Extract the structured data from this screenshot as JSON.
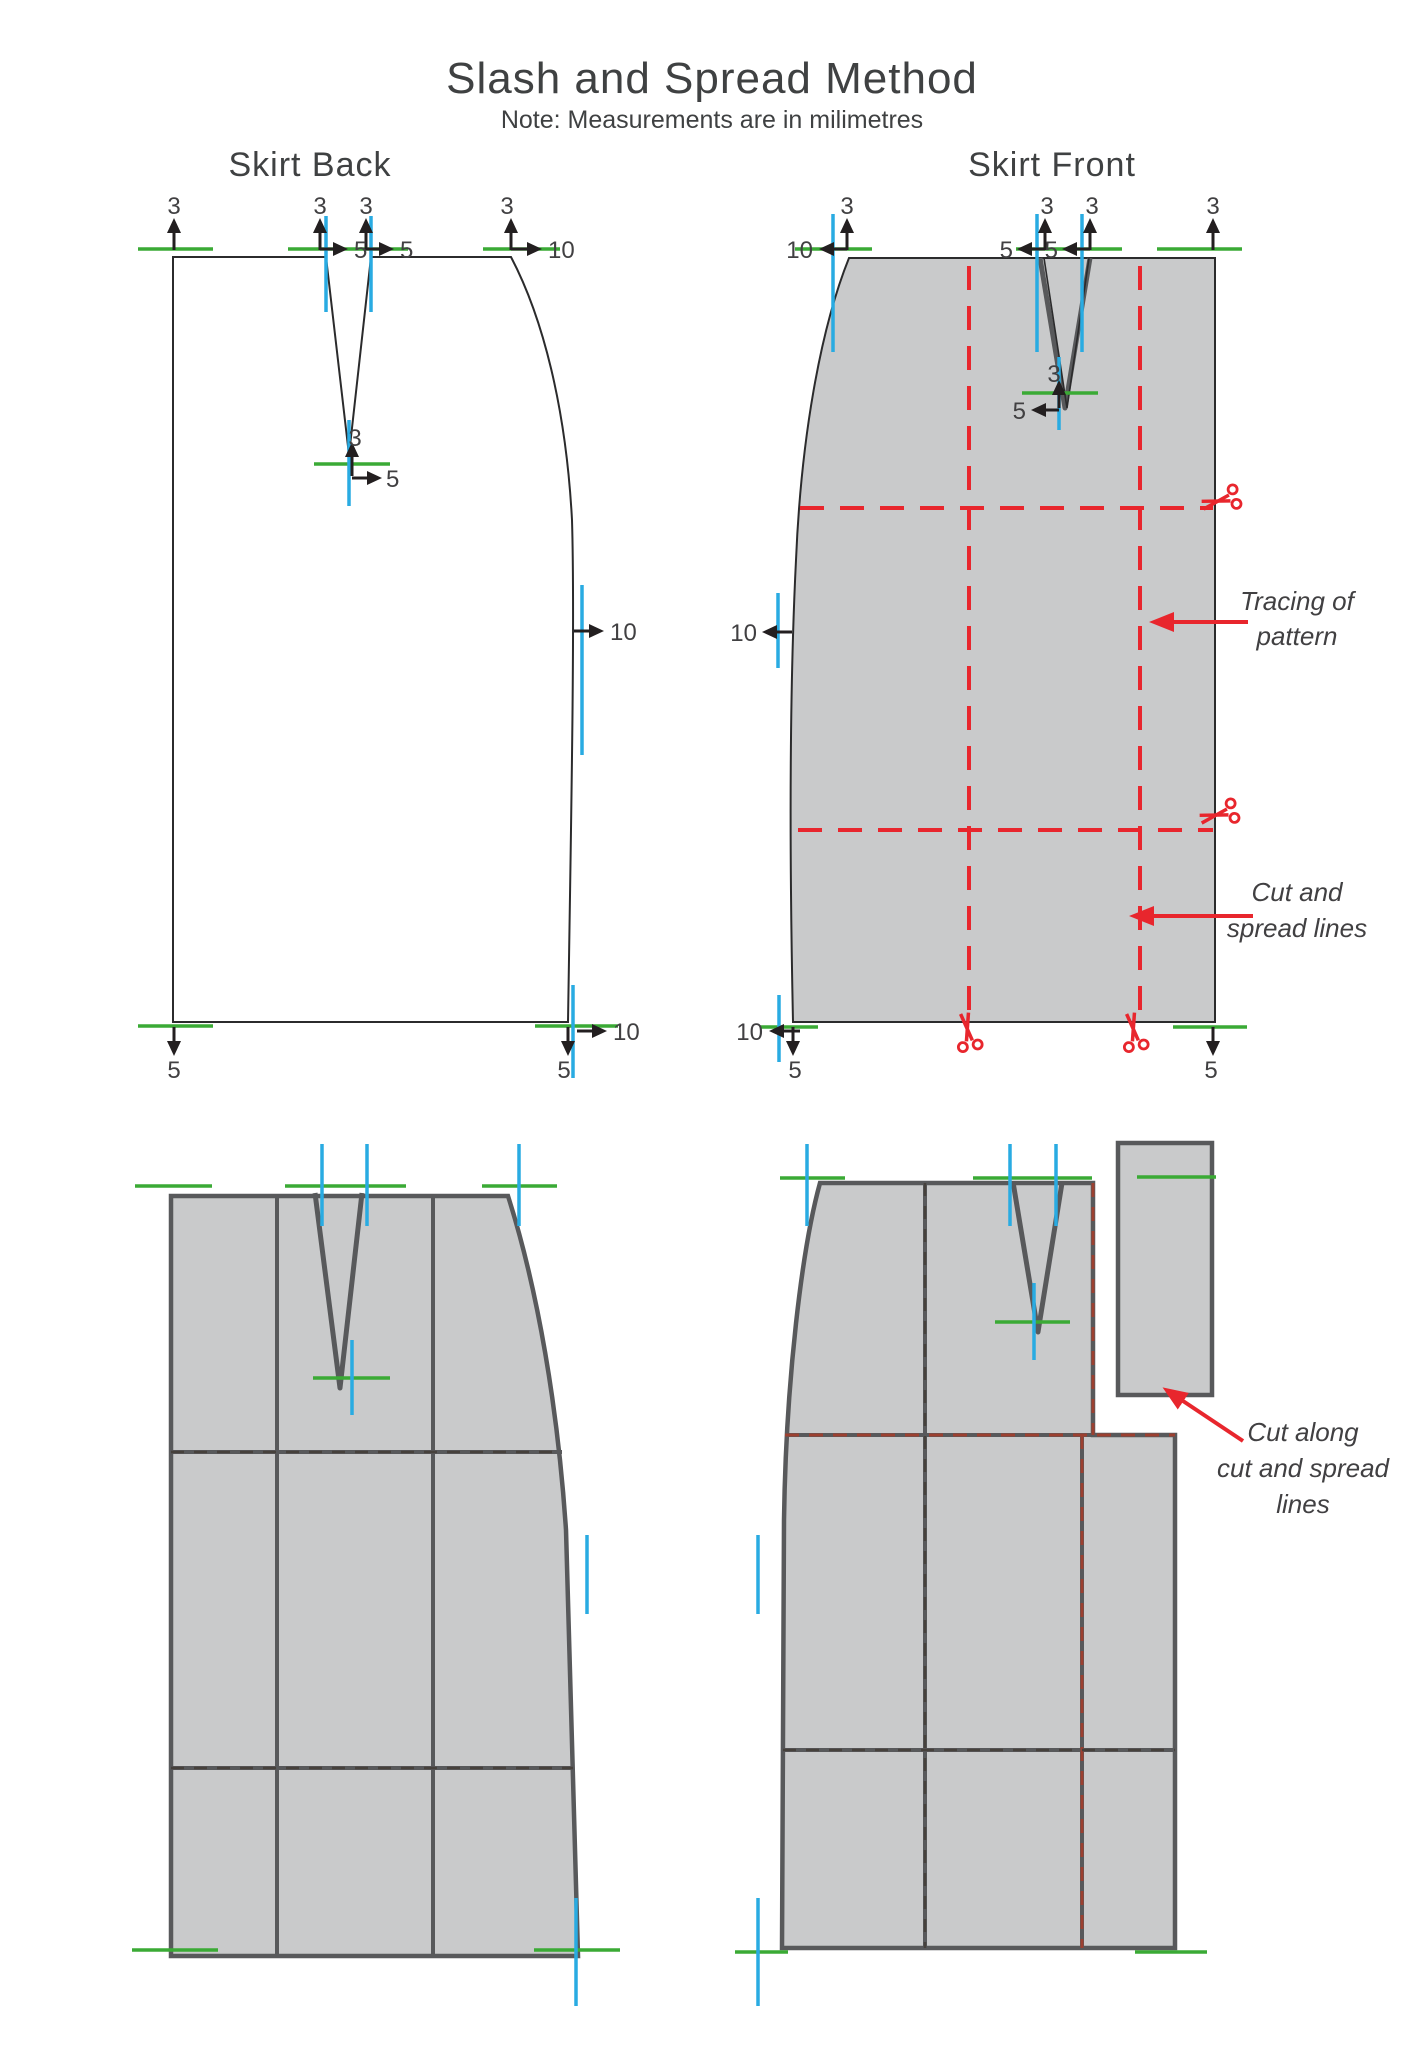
{
  "header": {
    "title": "Slash and Spread Method",
    "subtitle": "Note: Measurements are in milimetres"
  },
  "sections": {
    "back_label": "Skirt Back",
    "front_label": "Skirt Front"
  },
  "values": {
    "v3": "3",
    "v5": "5",
    "v10": "10"
  },
  "annotations": {
    "tracing_line1": "Tracing of",
    "tracing_line2": "pattern",
    "cut_spread_line1": "Cut and",
    "cut_spread_line2": "spread lines",
    "cut_along_line1": "Cut along",
    "cut_along_line2": "cut and spread",
    "cut_along_line3": "lines"
  },
  "icons": {
    "scissors": "scissors-icon"
  },
  "colors": {
    "registration_green": "#3aaa35",
    "registration_blue": "#29abe2",
    "cut_line_red": "#e8262d",
    "pattern_gray": "#c9cacb",
    "outline_gray": "#58595b",
    "outline_black": "#2b2b2c",
    "cut_dash_rust": "#9c4030",
    "text": "#414042"
  }
}
